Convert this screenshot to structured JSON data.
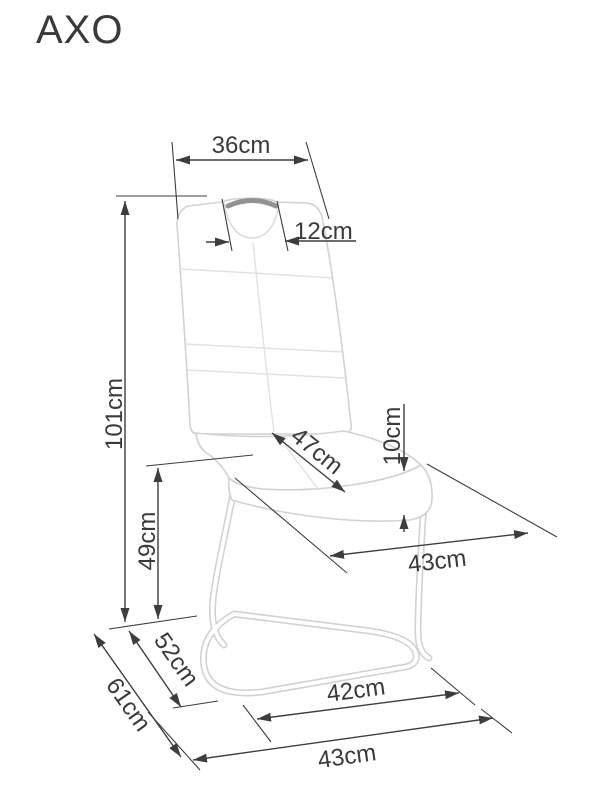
{
  "title": "AXO",
  "diagram_type": "chair dimension drawing",
  "dimensions": {
    "back_width": "36cm",
    "handle_width": "12cm",
    "total_height": "101cm",
    "seat_depth": "47cm",
    "cushion_thickness": "10cm",
    "seat_height": "49cm",
    "seat_width": "43cm",
    "base_depth": "52cm",
    "total_depth": "61cm",
    "base_width": "42cm",
    "overall_front_width": "43cm"
  },
  "colors": {
    "dimension_lines": "#3d3d3d",
    "label_text": "#3a3a3a",
    "chair_outline": "#d2d2d2",
    "stitch_lines": "#e1e1e1",
    "handle_grip": "#929292",
    "background": "#ffffff"
  }
}
